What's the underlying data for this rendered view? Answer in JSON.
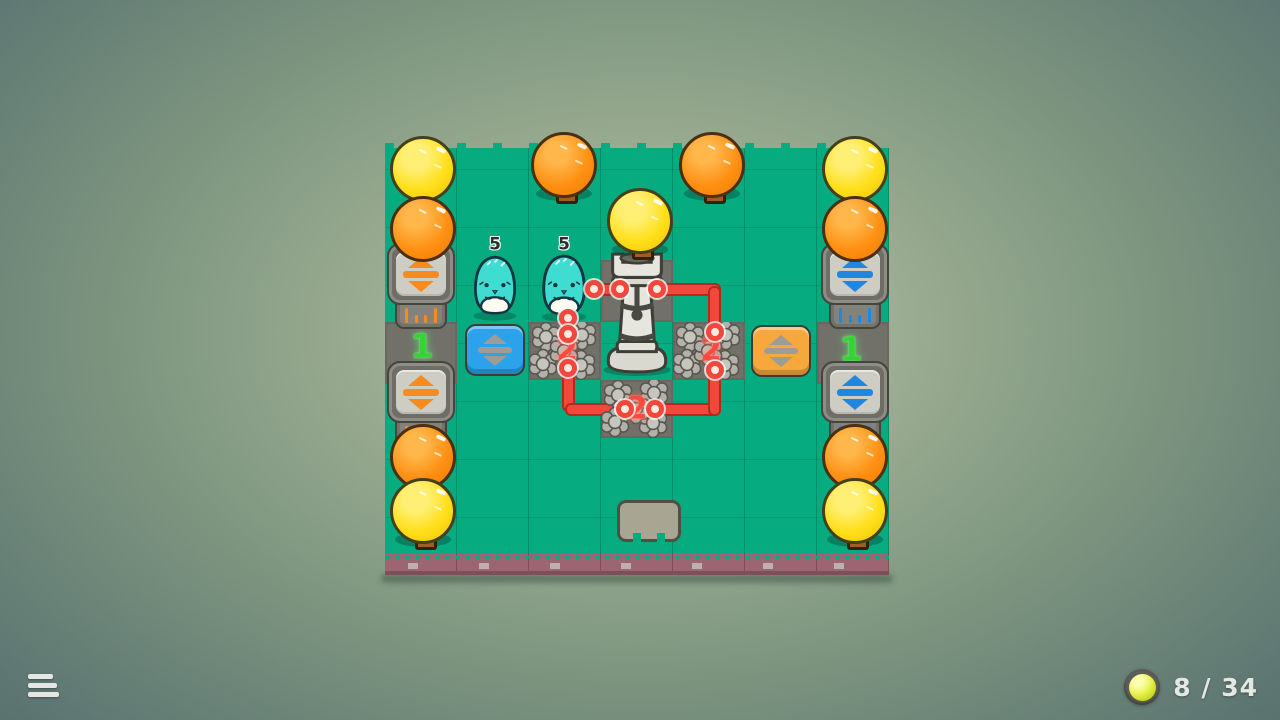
{
  "hud": {
    "menu_button": {
      "icon": "hamburger-icon"
    },
    "progress_counter": {
      "icon": "orb-icon",
      "text": "8 / 34",
      "current": 8,
      "total": 34
    }
  },
  "board": {
    "grid": {
      "columns": 7,
      "rows": 7
    },
    "creature_left_count": "5",
    "creature_right_count": "5",
    "rock_west_count": "2",
    "rock_east_count": "2",
    "rock_south_count": "2",
    "lane_left_count": "1",
    "lane_right_count": "1",
    "entities": [
      {
        "type": "tree",
        "color": "yellow",
        "col": 1,
        "row": 1
      },
      {
        "type": "tree",
        "color": "orange",
        "col": 1,
        "row": 2
      },
      {
        "type": "tree",
        "color": "orange",
        "col": 3,
        "row": 1
      },
      {
        "type": "tree",
        "color": "yellow",
        "col": 4,
        "row": 2
      },
      {
        "type": "tree",
        "color": "orange",
        "col": 5,
        "row": 1
      },
      {
        "type": "tree",
        "color": "yellow",
        "col": 7,
        "row": 1
      },
      {
        "type": "tree",
        "color": "orange",
        "col": 7,
        "row": 2
      },
      {
        "type": "tree",
        "color": "orange",
        "col": 1,
        "row": 6
      },
      {
        "type": "tree",
        "color": "yellow",
        "col": 1,
        "row": 7
      },
      {
        "type": "tree",
        "color": "orange",
        "col": 7,
        "row": 6
      },
      {
        "type": "tree",
        "color": "yellow",
        "col": 7,
        "row": 7
      },
      {
        "type": "piston",
        "color": "orange",
        "col": 1,
        "row": 3
      },
      {
        "type": "piston",
        "color": "orange",
        "col": 1,
        "row": 4
      },
      {
        "type": "piston",
        "color": "blue",
        "col": 7,
        "row": 3
      },
      {
        "type": "piston",
        "color": "blue",
        "col": 7,
        "row": 4
      },
      {
        "type": "button",
        "color": "blue",
        "col": 2,
        "row": 4
      },
      {
        "type": "button",
        "color": "orange",
        "col": 6,
        "row": 4
      },
      {
        "type": "creature",
        "color": "cyan",
        "col": 2,
        "row": 3,
        "count": "5"
      },
      {
        "type": "creature",
        "color": "cyan",
        "col": 3,
        "row": 3,
        "count": "5"
      },
      {
        "type": "castle",
        "col": 4,
        "row": 3
      },
      {
        "type": "rock",
        "col": 3,
        "row": 4,
        "count": "2"
      },
      {
        "type": "rock",
        "col": 5,
        "row": 4,
        "count": "2"
      },
      {
        "type": "rock",
        "col": 4,
        "row": 5,
        "count": "2"
      },
      {
        "type": "slab",
        "col": 4,
        "row": 7
      },
      {
        "type": "lane-marker",
        "col": 1,
        "row": 4,
        "count": "1"
      },
      {
        "type": "lane-marker",
        "col": 7,
        "row": 4,
        "count": "1"
      }
    ]
  },
  "colors": {
    "tile_green": "#06ab80",
    "wire_red": "#f2473b",
    "rock_number_red": "#fb4b40",
    "lane_number_green": "#35d435",
    "button_blue": "#2ba2ea",
    "button_orange": "#f7a83c",
    "arrow_orange": "#f68b1f",
    "arrow_blue": "#1f87e0",
    "dirt_band": "#9b6571"
  }
}
